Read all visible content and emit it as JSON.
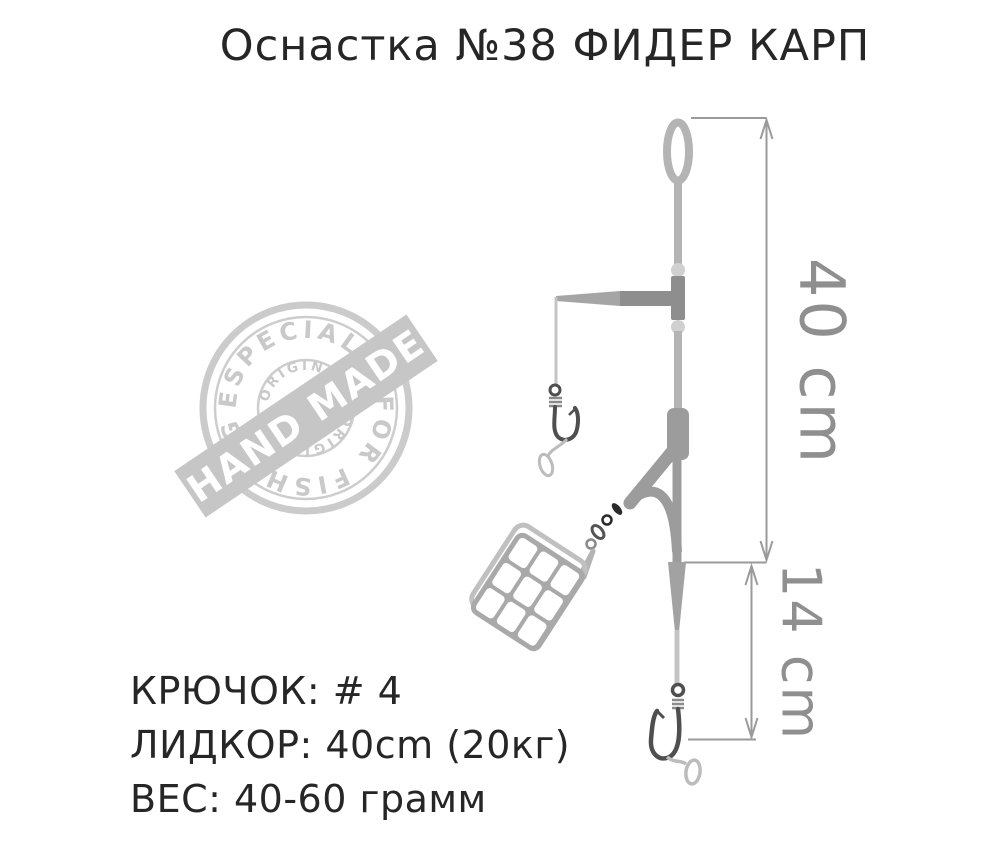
{
  "title": "Оснастка №38 ФИДЕР КАРП",
  "stamp": {
    "arc_top": "ESPECIALLY",
    "arc_bottom": "FOR FISHING",
    "inner_top": "ORIGINAL",
    "inner_bottom": "ORIGINAL",
    "banner": "HAND MADE"
  },
  "dimensions": {
    "main_line_length": "40 cm",
    "hook_link_length": "14 cm"
  },
  "specs": {
    "hook": "КРЮЧОК: # 4",
    "leadcore": "ЛИДКОР: 40cm (20кг)",
    "weight": "ВЕС: 40-60 грамм"
  },
  "colors": {
    "background": "#ffffff",
    "text_dark": "#262626",
    "line_light_gray": "#b4b4b4",
    "connector_gray": "#8e8e8e",
    "boom_gray": "#9c9c9c",
    "hook_dark_gray": "#4f4f4f",
    "hair_gray": "#bcbcbc",
    "dimension_gray": "#9a9a9a",
    "stamp_gray": "#c9c9c9",
    "feeder_frame_gray": "#a9a9a9"
  }
}
